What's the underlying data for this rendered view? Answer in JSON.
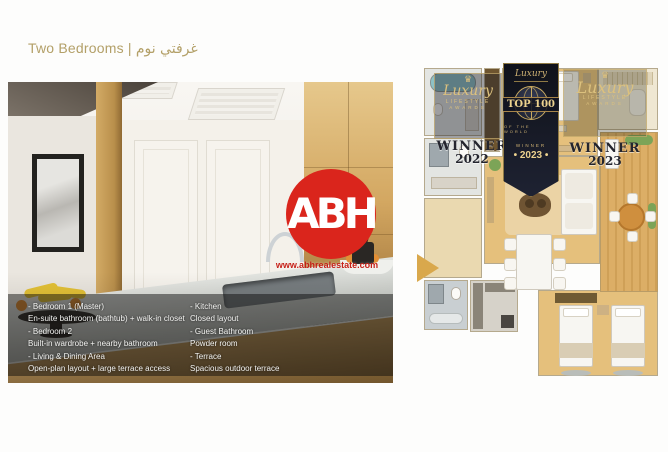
{
  "page": {
    "title_en": "Two Bedrooms",
    "title_sep": "|",
    "title_ar": "غرفتي نوم"
  },
  "photo": {
    "features_left": [
      {
        "heading": "- Bedroom 1 (Master)",
        "detail": "En-suite bathroom (bathtub) + walk-in closet"
      },
      {
        "heading": "- Bedroom 2",
        "detail": "Built-in wardrobe + nearby bathroom"
      },
      {
        "heading": "- Living & Dining Area",
        "detail": "Open-plan layout + large terrace access"
      }
    ],
    "features_right": [
      {
        "heading": "- Kitchen",
        "detail": "Closed layout"
      },
      {
        "heading": "- Guest Bathroom",
        "detail": "Powder room"
      },
      {
        "heading": "- Terrace",
        "detail": "Spacious outdoor terrace"
      }
    ]
  },
  "watermark": {
    "monogram": "ABH",
    "website": "www.abhrealestate.com"
  },
  "floorplan": {
    "badge_2022": {
      "crown": "♛",
      "brand": "Luxury",
      "line1": "LIFESTYLE",
      "line2": "AWARDS",
      "label": "WINNER",
      "year": "2022"
    },
    "badge_top100": {
      "brand": "Luxury",
      "title": "TOP 100",
      "subtitle": "OF THE WORLD",
      "label": "WINNER",
      "year": "• 2023 •"
    },
    "badge_2023": {
      "crown": "♛",
      "brand": "Luxury",
      "line1": "LIFESTYLE",
      "line2": "AWARDS",
      "label": "WINNER",
      "year": "2023"
    }
  },
  "colors": {
    "title_gold": "#b3a068",
    "logo_red": "#da251c",
    "badge_gold": "#d5b873",
    "plan_wood": "#e5c07c",
    "badge_dark": "#141722"
  }
}
